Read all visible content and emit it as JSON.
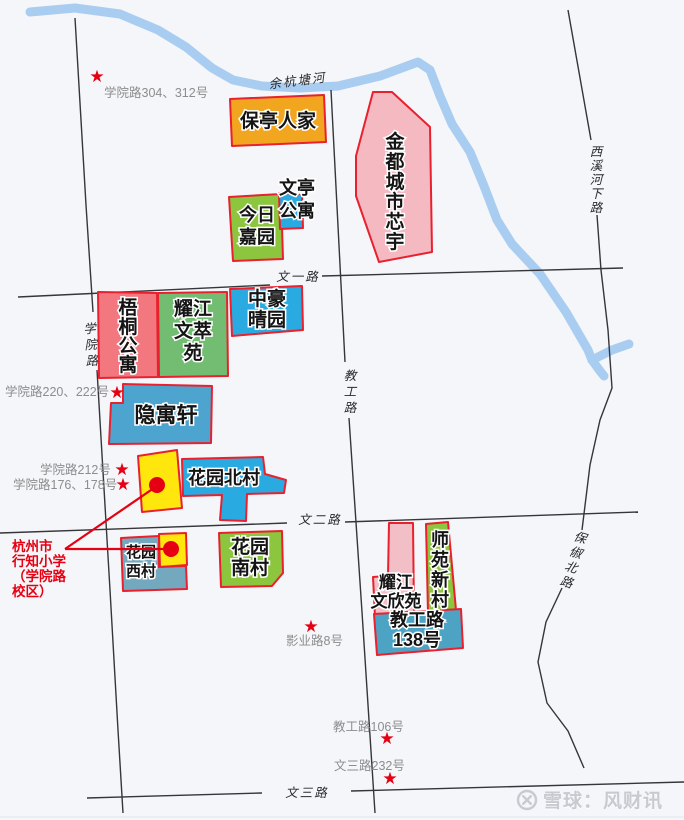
{
  "colors": {
    "bg": "#f4f6f9",
    "border": "#e9212e",
    "road": "#35353a",
    "river": "#a9cdf1",
    "star": "#e60014",
    "dot": "#e60014",
    "gray_label": "#8d8d8d",
    "school_text": "#e60012",
    "watermark": "#c7cad0"
  },
  "river": {
    "label": "余杭塘河",
    "label_x": 298,
    "label_y": 85,
    "label_rot": -7,
    "stroke_width": 9,
    "paths": [
      [
        [
          30,
          12
        ],
        [
          75,
          8
        ],
        [
          120,
          14
        ],
        [
          158,
          30
        ],
        [
          186,
          47
        ],
        [
          212,
          68
        ],
        [
          233,
          80
        ],
        [
          262,
          86
        ],
        [
          300,
          88
        ],
        [
          338,
          86
        ],
        [
          380,
          76
        ],
        [
          418,
          62
        ],
        [
          430,
          70
        ],
        [
          440,
          96
        ],
        [
          452,
          124
        ],
        [
          470,
          152
        ],
        [
          484,
          186
        ],
        [
          497,
          220
        ],
        [
          512,
          244
        ],
        [
          540,
          274
        ],
        [
          566,
          312
        ],
        [
          588,
          350
        ],
        [
          592,
          360
        ]
      ],
      [
        [
          592,
          360
        ],
        [
          612,
          350
        ],
        [
          629,
          344
        ]
      ],
      [
        [
          592,
          360
        ],
        [
          600,
          371
        ],
        [
          604,
          376
        ]
      ]
    ]
  },
  "roads": [
    {
      "id": "xueyuan-road",
      "label": "学院路",
      "vertical": true,
      "lx": 92,
      "ly": 333,
      "lh": 16,
      "rot": -4,
      "segments": [
        [
          [
            75,
            18
          ],
          [
            86,
            205
          ],
          [
            93,
            312
          ]
        ],
        [
          [
            97,
            370
          ],
          [
            110,
            590
          ],
          [
            118,
            730
          ],
          [
            123,
            813
          ]
        ]
      ]
    },
    {
      "id": "wenyi-road",
      "label": "文一路",
      "lx": 298,
      "ly": 281,
      "segments": [
        [
          [
            18,
            297
          ],
          [
            270,
            285
          ]
        ],
        [
          [
            322,
            276
          ],
          [
            623,
            268
          ]
        ]
      ]
    },
    {
      "id": "jiaogong-road",
      "label": "教工路",
      "vertical": true,
      "lx": 351,
      "ly": 380,
      "lh": 16,
      "segments": [
        [
          [
            331,
            90
          ],
          [
            345,
            362
          ]
        ],
        [
          [
            349,
            418
          ],
          [
            362,
            612
          ],
          [
            375,
            813
          ]
        ]
      ]
    },
    {
      "id": "wener-road",
      "label": "文二路",
      "lx": 320,
      "ly": 524,
      "segments": [
        [
          [
            0,
            533
          ],
          [
            287,
            523
          ]
        ],
        [
          [
            345,
            522
          ],
          [
            638,
            512
          ]
        ]
      ]
    },
    {
      "id": "wensan-road",
      "label": "文三路",
      "lx": 307,
      "ly": 797,
      "segments": [
        [
          [
            87,
            798
          ],
          [
            262,
            793
          ]
        ],
        [
          [
            351,
            791
          ],
          [
            684,
            782
          ]
        ]
      ]
    },
    {
      "id": "xixi-hexia-road",
      "label": "西溪河下路",
      "vertical": true,
      "lx": 597,
      "ly": 156,
      "lh": 14,
      "segments": [
        [
          [
            568,
            10
          ],
          [
            591,
            140
          ]
        ],
        [
          [
            597,
            215
          ],
          [
            601,
            270
          ],
          [
            608,
            330
          ],
          [
            612,
            388
          ],
          [
            600,
            420
          ],
          [
            590,
            465
          ],
          [
            582,
            530
          ]
        ]
      ]
    },
    {
      "id": "baochu-north-road",
      "label": "保俶北路",
      "vertical": true,
      "lx": 573,
      "ly": 541,
      "lh": 15.5,
      "rot": 17,
      "segments": [
        [
          [
            562,
            588
          ],
          [
            546,
            622
          ],
          [
            538,
            662
          ],
          [
            547,
            703
          ],
          [
            568,
            731
          ],
          [
            584,
            768
          ]
        ]
      ]
    }
  ],
  "blocks": [
    {
      "id": "baoting-renjia",
      "label": "保亭人家",
      "fill": "#f2a51e",
      "fs": 19,
      "points": [
        [
          230,
          99
        ],
        [
          324,
          95
        ],
        [
          326,
          142
        ],
        [
          232,
          146
        ]
      ],
      "lx": 278,
      "ly": 127
    },
    {
      "id": "jindu-chengshi-xinyu",
      "label": "金都城市芯宇",
      "fill": "#f4b9c1",
      "fs": 19,
      "vertical": true,
      "lh": 20,
      "points": [
        [
          373,
          92
        ],
        [
          392,
          92
        ],
        [
          430,
          127
        ],
        [
          432,
          252
        ],
        [
          379,
          262
        ],
        [
          356,
          196
        ],
        [
          356,
          156
        ]
      ],
      "lx": 395,
      "ly": 148
    },
    {
      "id": "jinri-jiayuan",
      "label": "今日|嘉园",
      "fill": "#8cc63e",
      "fs": 18,
      "lh": 22,
      "points": [
        [
          229,
          197
        ],
        [
          281,
          194
        ],
        [
          283,
          259
        ],
        [
          233,
          261
        ]
      ],
      "lx": 257,
      "ly": 221
    },
    {
      "id": "wenting-gongyu",
      "label": "文亭|公寓",
      "fill": "#29abe2",
      "fs": 18,
      "lh": 23,
      "points": [
        [
          279,
          193
        ],
        [
          302,
          194
        ],
        [
          303,
          228
        ],
        [
          280,
          229
        ]
      ],
      "lx": 297,
      "ly": 194
    },
    {
      "id": "wutong-gongyu",
      "label": "梧桐公寓",
      "fill": "#f2777f",
      "fs": 19,
      "vertical": true,
      "lh": 19,
      "points": [
        [
          98,
          292
        ],
        [
          157,
          293
        ],
        [
          158,
          377
        ],
        [
          99,
          378
        ]
      ],
      "lx": 128,
      "ly": 314
    },
    {
      "id": "yaojiang-wencui-yuan",
      "label": "耀江|文萃|苑",
      "fill": "#73bd73",
      "fs": 19,
      "lh": 22,
      "points": [
        [
          158,
          293
        ],
        [
          227,
          292
        ],
        [
          228,
          376
        ],
        [
          159,
          377
        ]
      ],
      "lx": 193,
      "ly": 315
    },
    {
      "id": "zhonghao-qingyuan",
      "label": "中豪|晴园",
      "fill": "#29abe2",
      "fs": 19,
      "lh": 21,
      "points": [
        [
          230,
          289
        ],
        [
          302,
          286
        ],
        [
          303,
          330
        ],
        [
          232,
          336
        ]
      ],
      "lx": 267,
      "ly": 305
    },
    {
      "id": "yinyuxuan",
      "label": "隐寓轩",
      "fill": "#4da4cf",
      "fs": 21,
      "points": [
        [
          123,
          384
        ],
        [
          212,
          386
        ],
        [
          211,
          443
        ],
        [
          109,
          444
        ],
        [
          111,
          403
        ],
        [
          123,
          403
        ]
      ],
      "lx": 166,
      "ly": 422
    },
    {
      "id": "school-block-north",
      "label": "",
      "fill": "#ffe70d",
      "points": [
        [
          138,
          456
        ],
        [
          177,
          450
        ],
        [
          182,
          508
        ],
        [
          142,
          512
        ]
      ]
    },
    {
      "id": "huayuan-beicun",
      "label": "花园北村",
      "fill": "#29abe2",
      "fs": 18,
      "points": [
        [
          182,
          459
        ],
        [
          263,
          457
        ],
        [
          265,
          474
        ],
        [
          286,
          480
        ],
        [
          284,
          493
        ],
        [
          247,
          494
        ],
        [
          246,
          521
        ],
        [
          220,
          520
        ],
        [
          222,
          495
        ],
        [
          183,
          496
        ]
      ],
      "lx": 224,
      "ly": 484
    },
    {
      "id": "school-block-west",
      "label": "",
      "fill": "#ffe70d",
      "points": [
        [
          159,
          534
        ],
        [
          186,
          533
        ],
        [
          187,
          565
        ],
        [
          160,
          567
        ]
      ]
    },
    {
      "id": "huayuan-xicun",
      "label": "花园|西村",
      "fill": "#73a8be",
      "fs": 15,
      "lh": 19,
      "points": [
        [
          121,
          538
        ],
        [
          159,
          536
        ],
        [
          159,
          567
        ],
        [
          186,
          566
        ],
        [
          187,
          589
        ],
        [
          123,
          591
        ]
      ],
      "lx": 141,
      "ly": 557
    },
    {
      "id": "huayuan-nancun",
      "label": "花园|南村",
      "fill": "#8cc63e",
      "fs": 19,
      "lh": 21,
      "points": [
        [
          219,
          533
        ],
        [
          282,
          531
        ],
        [
          283,
          573
        ],
        [
          272,
          586
        ],
        [
          221,
          587
        ]
      ],
      "lx": 250,
      "ly": 553
    },
    {
      "id": "yaojiang-wenxin-yuan",
      "label": "耀江|文欣苑",
      "fill": "#f3bfc6",
      "fs": 17,
      "lh": 19,
      "points": [
        [
          389,
          523
        ],
        [
          413,
          523
        ],
        [
          414,
          615
        ],
        [
          375,
          617
        ],
        [
          373,
          577
        ],
        [
          388,
          576
        ]
      ],
      "lx": 396,
      "ly": 588
    },
    {
      "id": "shiyuan-xincun",
      "label": "师苑新村",
      "fill": "#8cc63e",
      "fs": 18,
      "vertical": true,
      "lh": 20,
      "points": [
        [
          426,
          524
        ],
        [
          448,
          522
        ],
        [
          456,
          610
        ],
        [
          428,
          613
        ]
      ],
      "lx": 440,
      "ly": 546
    },
    {
      "id": "jiaogonglu-138",
      "label": "教工路|138号",
      "fill": "#4ca3c4",
      "fs": 18,
      "lh": 20,
      "points": [
        [
          374,
          614
        ],
        [
          461,
          609
        ],
        [
          463,
          648
        ],
        [
          377,
          655
        ]
      ],
      "lx": 417,
      "ly": 626
    }
  ],
  "stars": [
    [
      97,
      76
    ],
    [
      117,
      392
    ],
    [
      122,
      469
    ],
    [
      123,
      484
    ],
    [
      311,
      626
    ],
    [
      387,
      738
    ],
    [
      390,
      778
    ]
  ],
  "address_labels": [
    {
      "text": "学院路304、312号",
      "x": 104,
      "y": 97
    },
    {
      "text": "学院路220、222号",
      "x": 5,
      "y": 396
    },
    {
      "text": "学院路212号",
      "x": 40,
      "y": 474
    },
    {
      "text": "学院路176、178号",
      "x": 13,
      "y": 489
    },
    {
      "text": "影业路8号",
      "x": 286,
      "y": 645
    },
    {
      "text": "教工路106号",
      "x": 333,
      "y": 731
    },
    {
      "text": "文三路232号",
      "x": 334,
      "y": 770
    }
  ],
  "school": {
    "lines": [
      "杭州市",
      "行知小学",
      "（学院路",
      "校区）"
    ],
    "x": 12,
    "y": 551,
    "lh": 15,
    "dots": [
      [
        157,
        485,
        8
      ],
      [
        171,
        549,
        8
      ]
    ],
    "pointer_lines": [
      [
        [
          65,
          549
        ],
        [
          154,
          488
        ]
      ],
      [
        [
          65,
          549
        ],
        [
          163,
          549
        ]
      ]
    ]
  },
  "watermark": {
    "text": "雪球：风财讯"
  }
}
